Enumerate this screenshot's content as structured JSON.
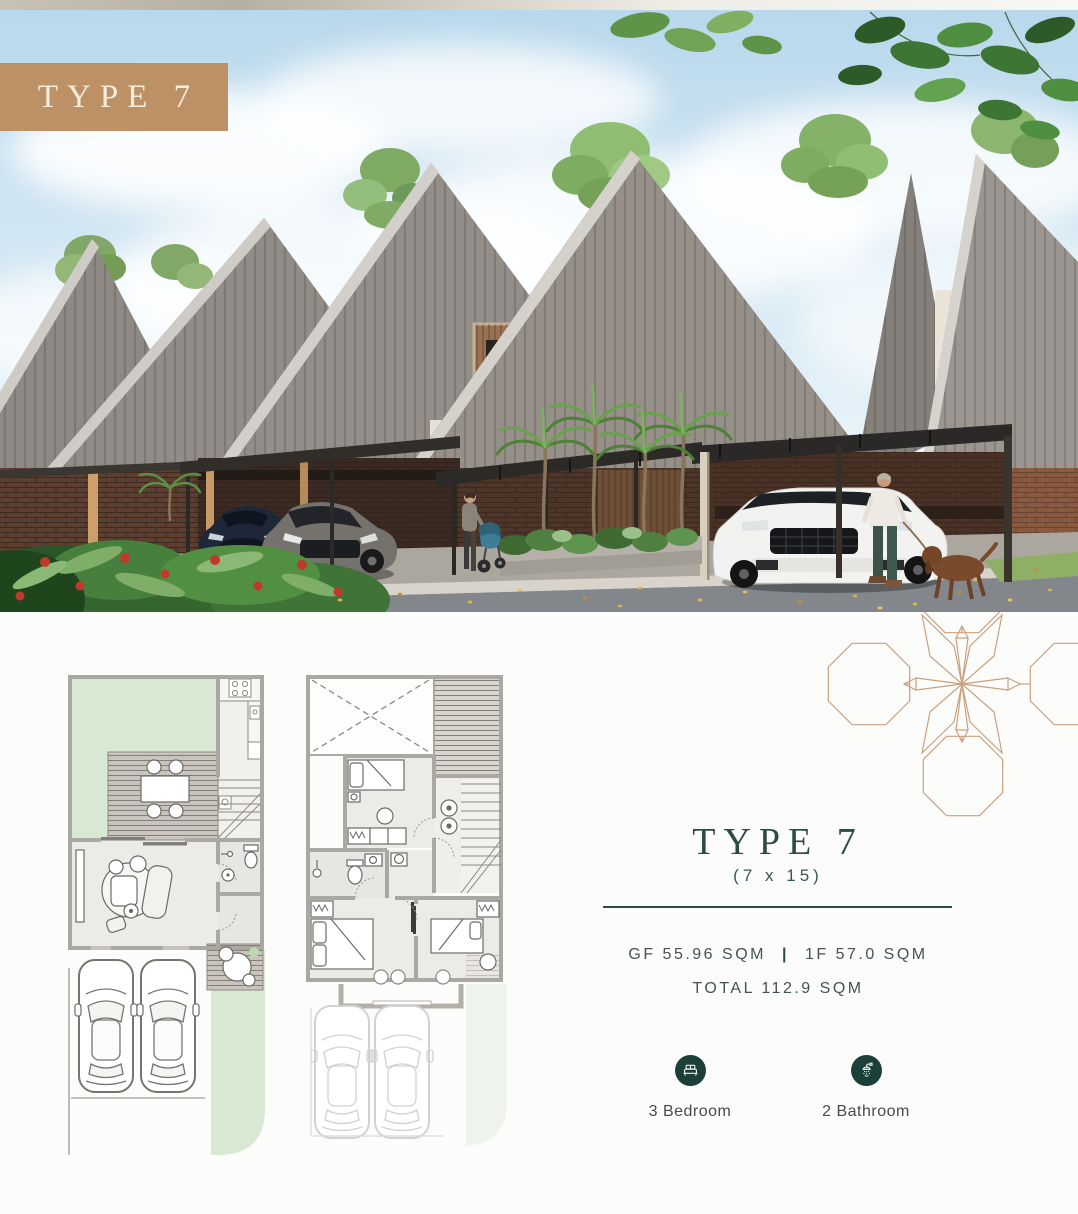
{
  "hero": {
    "badge_label": "TYPE 7"
  },
  "details": {
    "title": "TYPE 7",
    "dimensions": "(7 x 15)",
    "area_gf": "GF 55.96 SQM",
    "separator": "|",
    "area_1f": "1F 57.0 SQM",
    "area_total": "TOTAL 112.9 SQM",
    "features": [
      {
        "icon": "bed-icon",
        "label": "3 Bedroom"
      },
      {
        "icon": "shower-icon",
        "label": "2 Bathroom"
      }
    ]
  },
  "colors": {
    "badge_bg": "#BD9166",
    "badge_text": "#F6EDDB",
    "heading_teal": "#2E4B45",
    "spec_text": "#44534E",
    "icon_circle_bg": "#1C3F39",
    "icon_glyph": "#EAF1EC",
    "label_text": "#4A4A48",
    "ornament_line": "#C9A180",
    "plan_wall_gray": "#A9A8A3",
    "plan_garden_green": "#D9E8D2",
    "plan_room_fill": "#EBEBE8",
    "sky_blue": "#BCD9EC",
    "roof_gray": "#8E8983",
    "wood_facade": "#9A7253",
    "brick_brown": "#5C3F31"
  }
}
